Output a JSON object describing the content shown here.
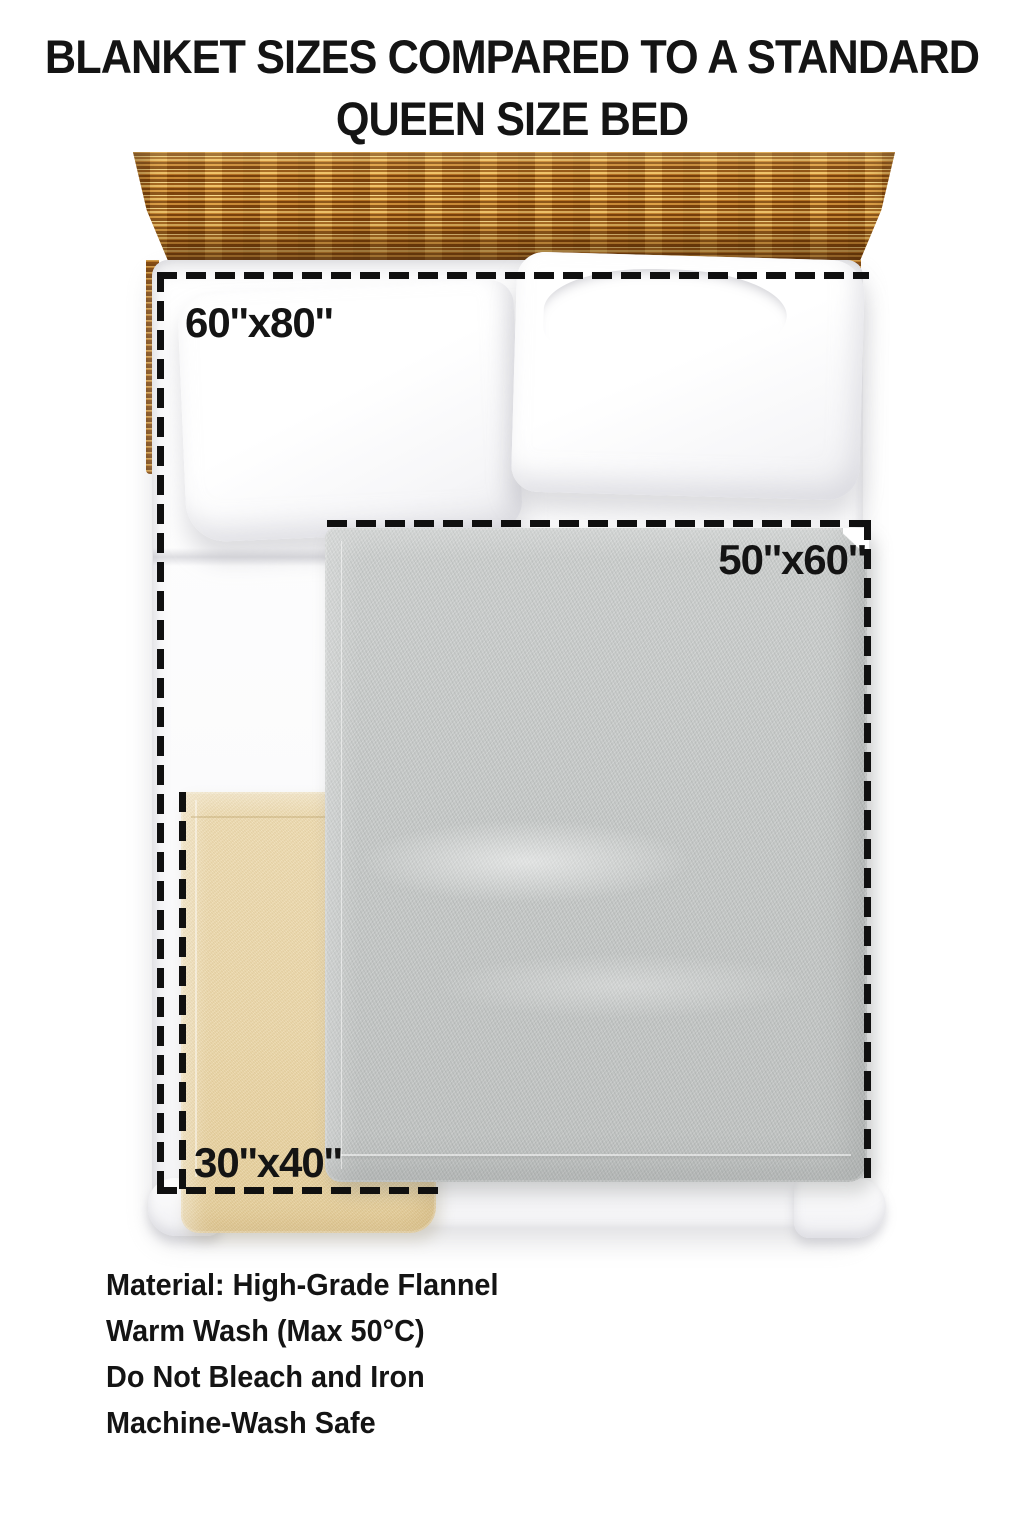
{
  "title": {
    "line1": "BLANKET SIZES COMPARED TO A STANDARD",
    "line2": "QUEEN SIZE BED"
  },
  "diagram": {
    "subject": "queen size bed top view with headboard, two pillows and layered blankets",
    "labels": {
      "large": "60''x80''",
      "medium": "50''x60''",
      "small": "30''x40''"
    }
  },
  "care_info": {
    "lines": [
      "Material: High-Grade Flannel",
      "Warm Wash (Max 50°C)",
      "Do Not Bleach and Iron",
      "Machine-Wash Safe"
    ]
  },
  "colors": {
    "page_bg": "#ffffff",
    "text": "#141414",
    "dash": "#101010",
    "blanket_gray": "#c7cac9",
    "blanket_gray_dark": "#c0c3c2",
    "blanket_tan": "#ecd8ab",
    "blanket_tan_dark": "#e6cf9b",
    "wood_dark": "#7c430c",
    "wood_light": "#ecc068",
    "wood_pale": "#f6d88e"
  }
}
